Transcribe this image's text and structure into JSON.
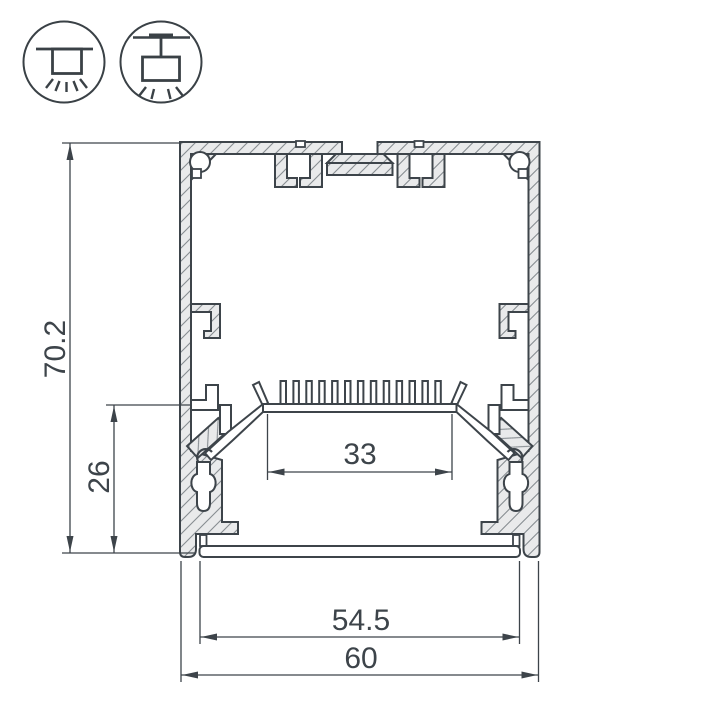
{
  "icons": {
    "surface_mount": "surface-mount-luminaire-icon",
    "pendant_mount": "pendant-mount-luminaire-icon"
  },
  "dimensions": {
    "overall_height": {
      "value": "70.2"
    },
    "inner_height": {
      "value": "26"
    },
    "led_platform_width": {
      "value": "33"
    },
    "inner_width": {
      "value": "54.5"
    },
    "overall_width": {
      "value": "60"
    }
  },
  "colors": {
    "background": "#ffffff",
    "line": "#3d444a",
    "aluminum_fill": "#e9eaeb",
    "hatch_line": "#878d92"
  }
}
